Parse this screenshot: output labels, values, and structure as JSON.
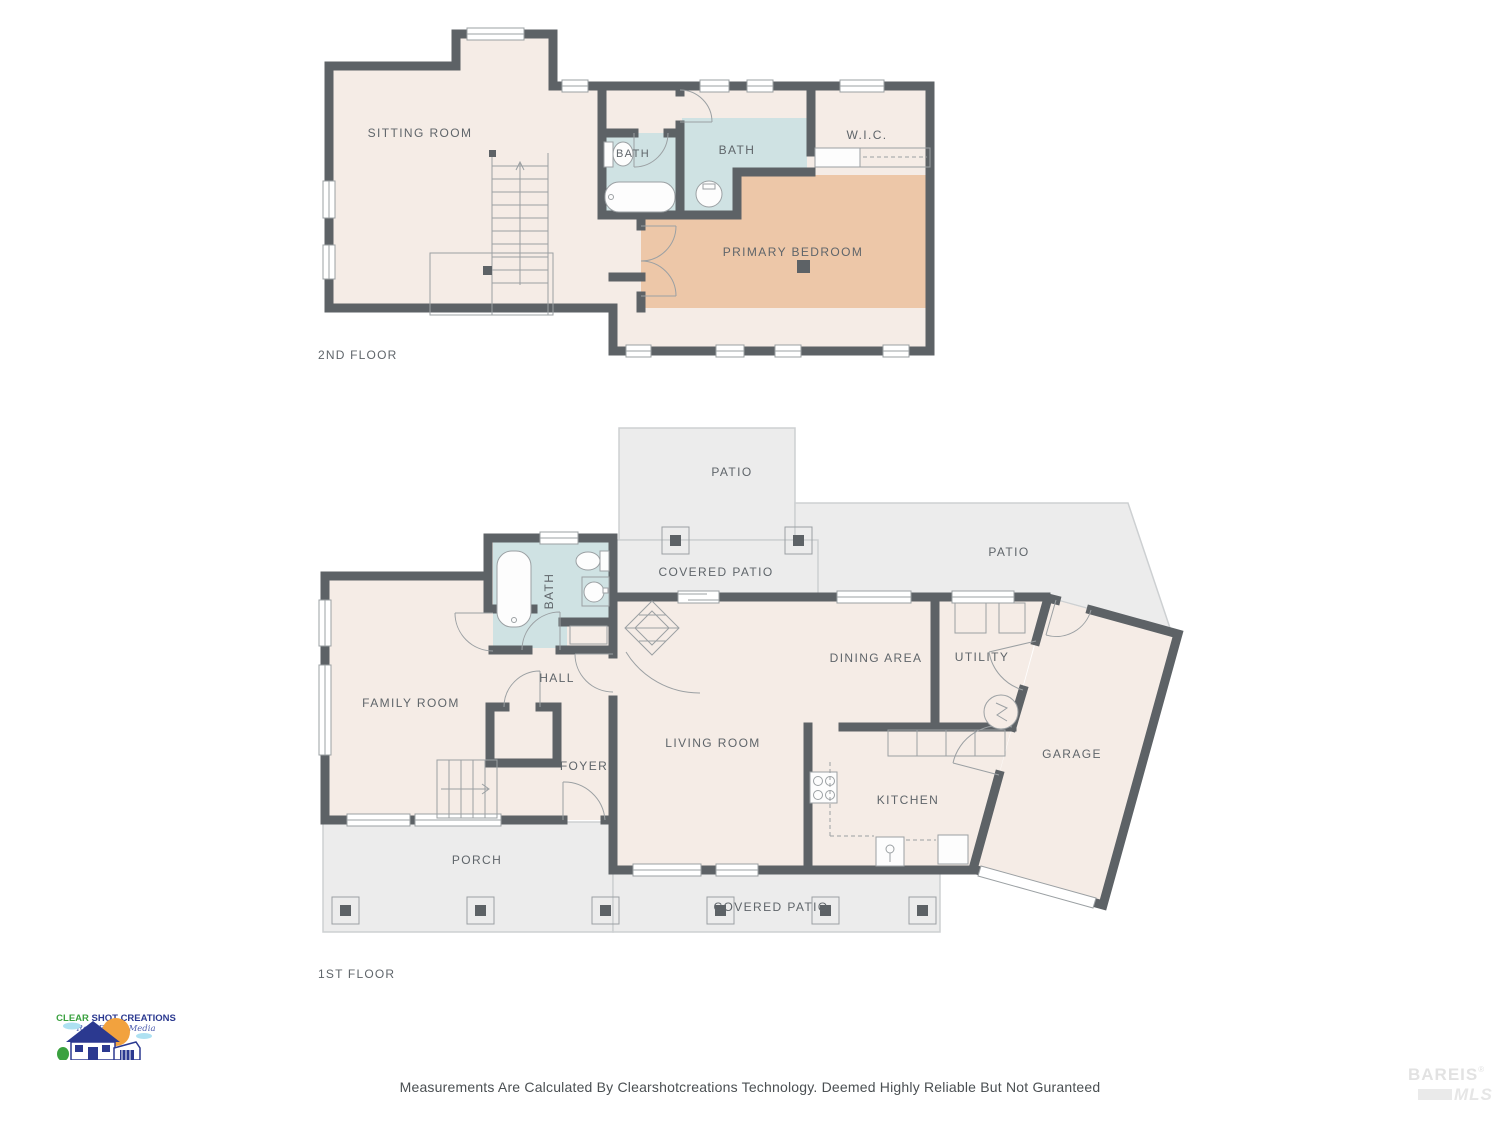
{
  "floors": [
    {
      "id": "second",
      "title": "2ND FLOOR",
      "rooms": [
        {
          "name": "sitting-room",
          "label": "SITTING ROOM"
        },
        {
          "name": "bath-small",
          "label": "BATH"
        },
        {
          "name": "bath-main",
          "label": "BATH"
        },
        {
          "name": "walk-in-closet",
          "label": "W.I.C."
        },
        {
          "name": "primary-bedroom",
          "label": "PRIMARY BEDROOM"
        }
      ]
    },
    {
      "id": "first",
      "title": "1ST FLOOR",
      "rooms": [
        {
          "name": "patio-top",
          "label": "PATIO"
        },
        {
          "name": "covered-patio-top",
          "label": "COVERED PATIO"
        },
        {
          "name": "patio-right",
          "label": "PATIO"
        },
        {
          "name": "bath",
          "label": "BATH"
        },
        {
          "name": "hall",
          "label": "HALL"
        },
        {
          "name": "family-room",
          "label": "FAMILY ROOM"
        },
        {
          "name": "dining-area",
          "label": "DINING AREA"
        },
        {
          "name": "utility",
          "label": "UTILITY"
        },
        {
          "name": "garage",
          "label": "GARAGE"
        },
        {
          "name": "foyer",
          "label": "FOYER"
        },
        {
          "name": "living-room",
          "label": "LIVING ROOM"
        },
        {
          "name": "kitchen",
          "label": "KITCHEN"
        },
        {
          "name": "porch",
          "label": "PORCH"
        },
        {
          "name": "covered-patio-bottom",
          "label": "COVERED PATIO"
        }
      ]
    }
  ],
  "footer": {
    "disclaimer": "Measurements Are Calculated By Clearshotcreations Technology. Deemed Highly Reliable But Not Guranteed"
  },
  "logo": {
    "name_green": "CLEAR",
    "name_rest": " SHOT CREATIONS",
    "tagline": "Real Estate Media"
  },
  "watermark": {
    "line1": "BAREIS",
    "reg": "®",
    "line2": "MLS"
  },
  "colors": {
    "wall": "#5d6266",
    "room_fill": "#f5ece6",
    "bath_fill": "#cfe2e3",
    "bedroom_fill": "#edc7a8",
    "patio_fill": "#ececec",
    "fixture_line": "#9ba0a3",
    "label_text": "#5f656a",
    "logo_green": "#3aa13f",
    "logo_blue": "#2b3990"
  }
}
